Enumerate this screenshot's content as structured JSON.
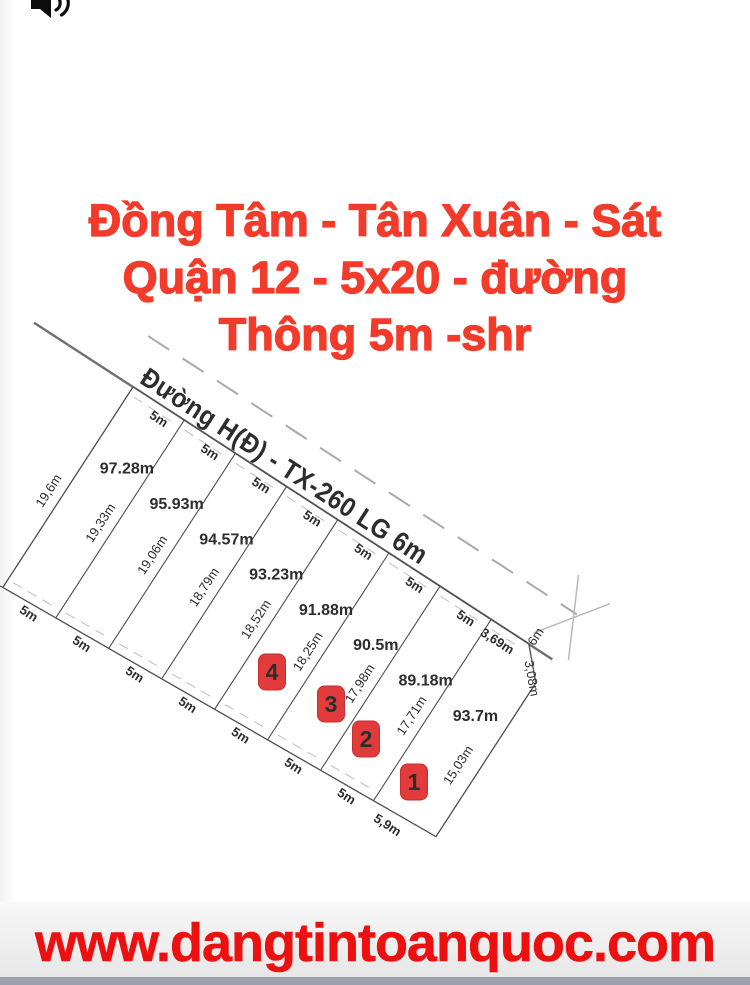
{
  "title": {
    "lines": [
      "Đồng Tâm - Tân Xuân - Sát",
      "Quận 12 - 5x20 - đường",
      "Thông 5m -shr"
    ]
  },
  "diagram": {
    "road": {
      "label": "Đường H(Đ) - TX-260 LG 6m",
      "width_label": "6m"
    },
    "plots": [
      {
        "area": "97.28m",
        "frontage": "5m",
        "bottom": "5m"
      },
      {
        "area": "95.93m",
        "frontage": "5m",
        "bottom": "5m"
      },
      {
        "area": "94.57m",
        "frontage": "5m",
        "bottom": "5m"
      },
      {
        "area": "93.23m",
        "frontage": "5m",
        "bottom": "5m"
      },
      {
        "area": "91.88m",
        "frontage": "5m",
        "bottom": "5m"
      },
      {
        "area": "90.5m",
        "frontage": "5m",
        "bottom": "5m"
      },
      {
        "area": "89.18m",
        "frontage": "5m",
        "bottom": "5m"
      },
      {
        "area": "93.7m",
        "frontage": "3,69m",
        "bottom": "5,9m"
      }
    ],
    "side_labels": [
      "19,6m",
      "19,33m",
      "19,06m",
      "18,79m",
      "18,52m",
      "18,25m",
      "17,98m",
      "17,71m",
      "15,03m"
    ],
    "corner_label": "3,08m",
    "badges": [
      {
        "number": "4"
      },
      {
        "number": "3"
      },
      {
        "number": "2"
      },
      {
        "number": "1"
      }
    ]
  },
  "footer": {
    "url": "www.dangtintoanquoc.com"
  },
  "colors": {
    "title_red": "#f23b2b",
    "badge_red": "#e23b3b",
    "url_red": "#ec1010",
    "footer_bar_gray": "#9ba1ab"
  }
}
